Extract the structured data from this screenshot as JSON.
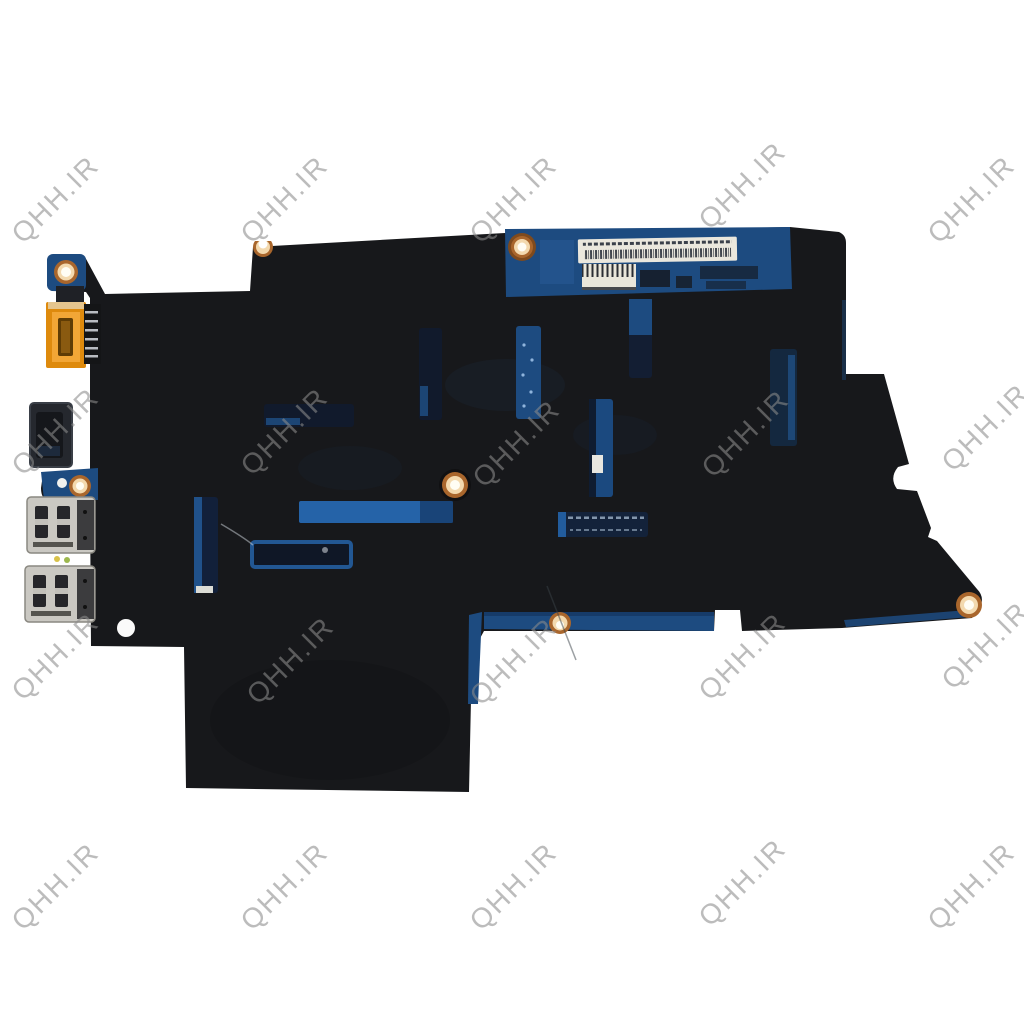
{
  "page": {
    "background_color": "#ffffff",
    "subject": "Laptop motherboard product photo (underside covered with black insulating mylar)"
  },
  "watermark": {
    "text": "QHH.IR",
    "color": "#8c8c8c",
    "opacity": 0.58,
    "rotation_deg": -45,
    "font_size": 28,
    "positions": [
      {
        "x": 62,
        "y": 206
      },
      {
        "x": 291,
        "y": 206
      },
      {
        "x": 520,
        "y": 206
      },
      {
        "x": 749,
        "y": 192
      },
      {
        "x": 978,
        "y": 206
      },
      {
        "x": 62,
        "y": 438
      },
      {
        "x": 291,
        "y": 438
      },
      {
        "x": 523,
        "y": 450
      },
      {
        "x": 752,
        "y": 440
      },
      {
        "x": 992,
        "y": 434
      },
      {
        "x": 62,
        "y": 663
      },
      {
        "x": 297,
        "y": 667
      },
      {
        "x": 520,
        "y": 668
      },
      {
        "x": 749,
        "y": 663
      },
      {
        "x": 992,
        "y": 652
      },
      {
        "x": 62,
        "y": 893
      },
      {
        "x": 291,
        "y": 893
      },
      {
        "x": 520,
        "y": 893
      },
      {
        "x": 749,
        "y": 889
      },
      {
        "x": 978,
        "y": 893
      }
    ]
  },
  "board": {
    "colors": {
      "cover": "#17181b",
      "pcb": "#1d4b80",
      "pcb_bright": "#2563a8",
      "slot_dark": "#111a2c",
      "copper": "#a9662c",
      "copper_light": "#f3d9ae",
      "label_bg": "#eae7dd",
      "connector_orange": "#de8a0d",
      "usb_silver": "#cac8c2",
      "port_dark": "#25282e"
    },
    "parts": [
      "mylar-cover",
      "pcb-edge",
      "barcode-label",
      "pin-header-connector",
      "dc-power-connector",
      "video-port",
      "usb-port-upper",
      "usb-port-lower",
      "screw-holes",
      "vent-slots"
    ]
  }
}
